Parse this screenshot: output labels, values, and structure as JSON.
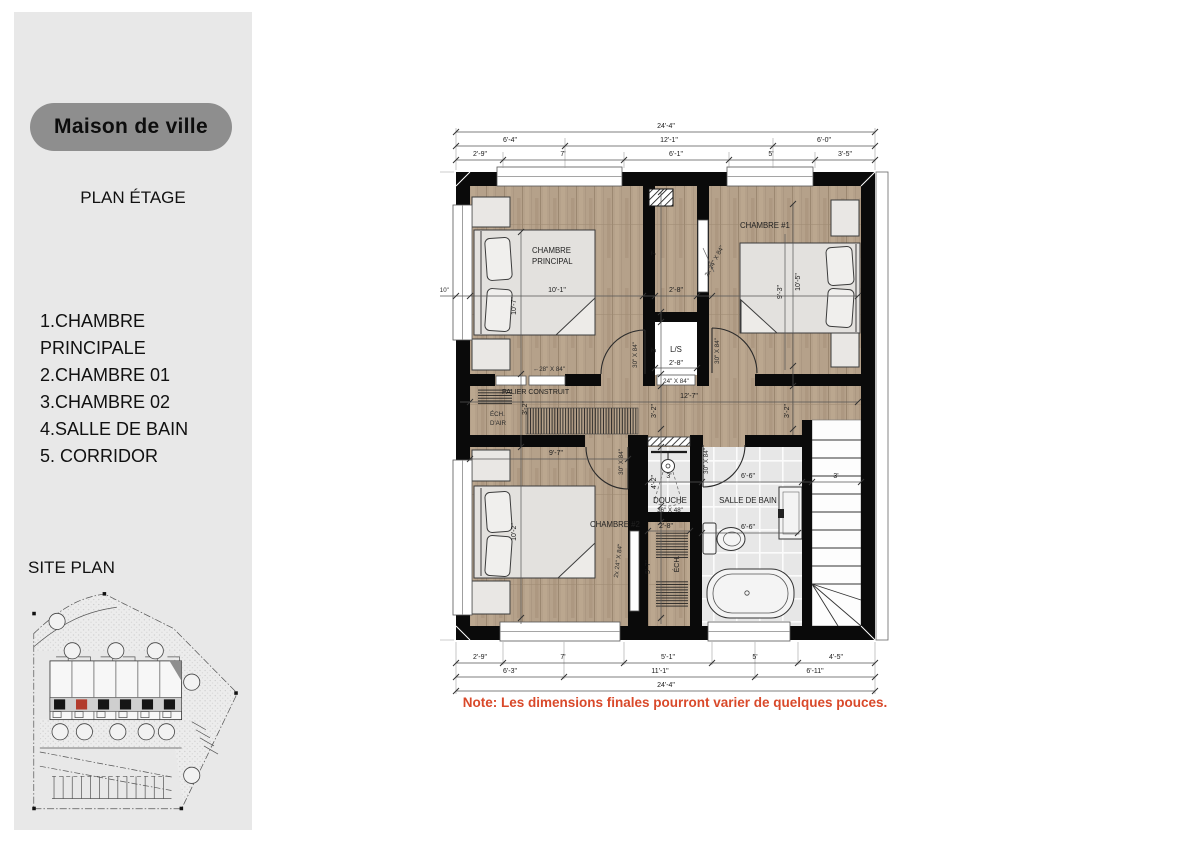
{
  "sidebar": {
    "title": "Maison de ville",
    "subtitle": "PLAN ÉTAGE",
    "legend": [
      "1.CHAMBRE PRINCIPALE",
      "2.CHAMBRE 01",
      "3.CHAMBRE 02",
      "4.SALLE DE BAIN",
      "5. CORRIDOR"
    ],
    "site_plan_label": "SITE PLAN"
  },
  "plan": {
    "note": "Note: Les dimensions finales pourront varier de quelques pouces.",
    "rooms": {
      "master": [
        "CHAMBRE",
        "PRINCIPAL"
      ],
      "c1": "CHAMBRE #1",
      "c2": "CHAMBRE #2",
      "ls": "L/S",
      "bath": "SALLE DE BAIN",
      "douche": [
        "DOUCHE",
        "36\" X 48\""
      ],
      "palier": "PALIER CONSTRUIT",
      "ech_air": [
        "ÉCH.",
        "D'AIR"
      ],
      "ech": "ÉCH."
    },
    "dims": {
      "top_total": "24'-4\"",
      "top_mid": [
        "6'-4\"",
        "12'-1\"",
        "6'-0\""
      ],
      "top_inner": [
        "2'-9\"",
        "7'",
        "6'-1\"",
        "5'",
        "3'-5\""
      ],
      "bottom_inner": [
        "2'-9\"",
        "7'",
        "5'-1\"",
        "5'",
        "4'-5\""
      ],
      "bottom_mid": [
        "6'-3\"",
        "11'-1\"",
        "6'-11\""
      ],
      "bottom_total": "24'-4\"",
      "left_total": "26'-8\"",
      "left_offset": "0'-10\"",
      "master_w": "10'-1\"",
      "master_h": "10'-7\"",
      "c1_d1": "9'-3\"",
      "c1_d2": "10'-5\"",
      "c2_w": "9'-7\"",
      "c2_h": "10'-2\"",
      "closet_h": "7'",
      "closet_w": "2'-8\"",
      "ls_h": "3'",
      "ls_w": "2'-8\"",
      "corridor_w": "12'-7\"",
      "corridor_left": "3'-2\"",
      "corridor_right": "3'-2\"",
      "palier": "3'-2\"",
      "douche_h": "4'-2\"",
      "douche_w": "3'",
      "bath_w1": "6'-6\"",
      "bath_w2": "6'-6\"",
      "stair_w": "3'",
      "shaft_h": "5'-7\"",
      "shaft_w": "2'-8\""
    },
    "doors": {
      "d28": "←28\" X 84\"",
      "d30": "30\" X 84\"",
      "d24": "24\" X 84\"",
      "d2x24": "2x 24\" X 84\""
    }
  },
  "colors": {
    "note_text": "#d9492a",
    "wall": "#0a0a0a",
    "wood_floor": "#b5a18a",
    "tile_floor": "#e7e7e7",
    "sidebar_bg": "#e8e8e8",
    "pill_bg": "#8e8e8e",
    "site_unit_highlight": "#b23b2c"
  }
}
